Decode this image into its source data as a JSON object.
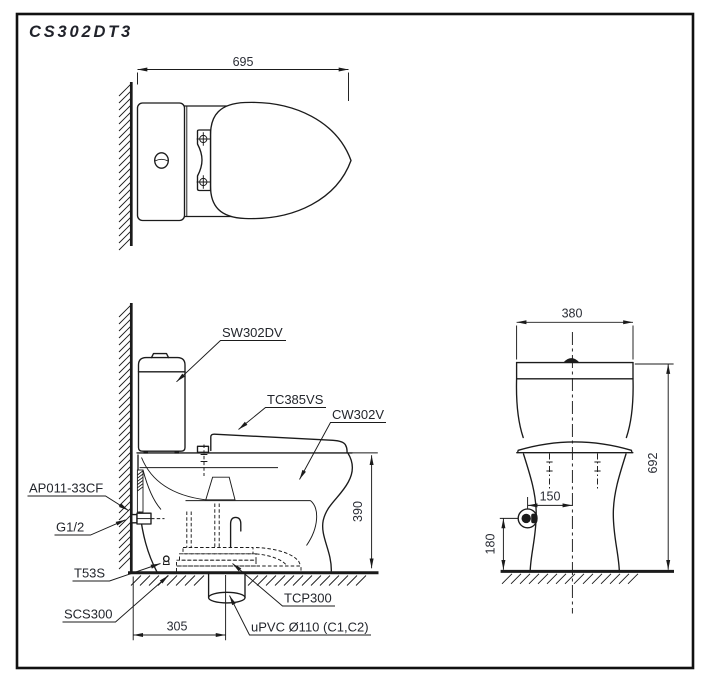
{
  "drawing": {
    "title": "CS302DT3",
    "colors": {
      "line": "#1b1b1b",
      "background": "#ffffff"
    },
    "plan_view": {
      "dim_width": "695"
    },
    "side_view": {
      "labels": {
        "tank": "SW302DV",
        "seat_cover": "TC385VS",
        "bowl": "CW302V",
        "supply_valve": "AP011-33CF",
        "supply_thread": "G1/2",
        "fixing_bolt": "T53S",
        "floor_seal": "SCS300",
        "outlet_socket": "TCP300",
        "drain_pipe": "uPVC Ø110 (C1,C2)"
      },
      "dims": {
        "rim_height": "390",
        "outlet_from_wall": "305"
      }
    },
    "front_view": {
      "dims": {
        "tank_width": "380",
        "total_height": "692",
        "supply_offset": "150",
        "supply_height": "180"
      }
    }
  }
}
